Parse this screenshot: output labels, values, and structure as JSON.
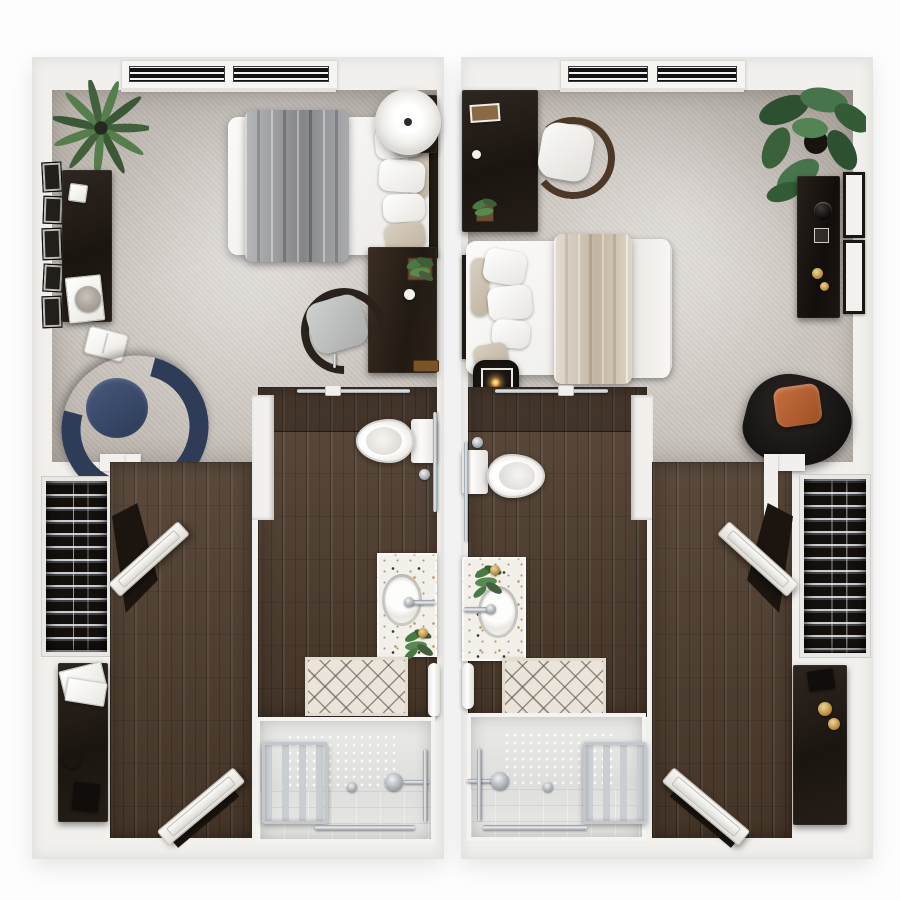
{
  "scene": {
    "label": "Top-down 3D floor plan rendering of two mirrored studio apartment units",
    "units": [
      {
        "id": "left",
        "label": "Left studio unit",
        "rooms": [
          {
            "name": "bedroom",
            "floor": "carpet",
            "furniture": [
              "palm-plant",
              "gallery-wall-frames",
              "writing-desk",
              "desk-photo-frame",
              "desk-papers",
              "woven-hat",
              "floor-book",
              "navy-barrel-chair",
              "twin-bed",
              "gray-duvet",
              "white-pillows",
              "tan-pillow",
              "round-lamp-table",
              "wall-console",
              "console-plant",
              "trinket-dish",
              "wood-tray",
              "office-chair",
              "window-pair"
            ]
          },
          {
            "name": "bathroom",
            "floor": "dark-wood",
            "furniture": [
              "sliding-door-rail",
              "pocket-niche",
              "toilet",
              "toilet-flush-button",
              "grab-bar",
              "speckled-vanity",
              "round-sink",
              "faucet",
              "vanity-plant",
              "gold-dish",
              "diamond-lattice-rug",
              "towel-pedestal",
              "roll-in-shower",
              "anti-slip-mat",
              "towel-ladder",
              "shower-head",
              "glide-bar",
              "shower-grab-bar",
              "floor-drain"
            ]
          },
          {
            "name": "closet",
            "floor": "dark-wood",
            "furniture": [
              "hanging-clothes-rod",
              "closet-door"
            ]
          },
          {
            "name": "entry",
            "floor": "dark-wood",
            "furniture": [
              "sideboard",
              "tissue-papers",
              "round-jar",
              "dark-book",
              "entry-door"
            ]
          }
        ]
      },
      {
        "id": "right",
        "label": "Right studio unit (mirrored)",
        "rooms": [
          {
            "name": "bedroom",
            "floor": "carpet",
            "furniture": [
              "corner-desk",
              "desk-photo-frame",
              "desk-cup",
              "desk-plant",
              "wood-back-chair",
              "queen-bed",
              "tan-throw",
              "white-duvet",
              "white-pillows",
              "tan-pillow",
              "candle-side-table",
              "monstera-plant",
              "wall-console",
              "black-bowl",
              "gold-candles",
              "picture-frames",
              "black-lounge-chair",
              "rust-pillow",
              "window-pair"
            ]
          },
          {
            "name": "bathroom",
            "floor": "dark-wood",
            "furniture": [
              "sliding-door-rail",
              "pocket-niche",
              "toilet",
              "toilet-flush-button",
              "grab-bar",
              "speckled-vanity",
              "round-sink",
              "faucet",
              "vanity-plant",
              "gold-dish",
              "diamond-lattice-rug",
              "towel-pedestal",
              "roll-in-shower",
              "anti-slip-mat",
              "towel-ladder",
              "shower-head",
              "glide-bar",
              "shower-grab-bar",
              "floor-drain"
            ]
          },
          {
            "name": "closet",
            "floor": "dark-wood",
            "furniture": [
              "hanging-clothes-rod",
              "closet-door"
            ]
          },
          {
            "name": "entry",
            "floor": "dark-wood",
            "furniture": [
              "sideboard",
              "dark-book",
              "gold-candles",
              "entry-door"
            ]
          }
        ]
      }
    ]
  },
  "palette": {
    "bg": "#fdfdfd",
    "wall": "#f1f0ed",
    "wall_shade": "#dedbd6",
    "carpet": "#cbc5be",
    "wood": "#4e3c2d",
    "wood_dark": "#382a1f",
    "espresso": "#221b15",
    "blanket_gray": "#97989b",
    "blanket_tan": "#d2c6b3",
    "navy": "#2e3c58",
    "rust": "#b0603a",
    "green_dark": "#30512f",
    "green_light": "#54784a",
    "silver": "#b9bdc1",
    "shower_floor": "#e6e6e4",
    "rug": "#eae4da",
    "gold": "#c08f3f"
  }
}
